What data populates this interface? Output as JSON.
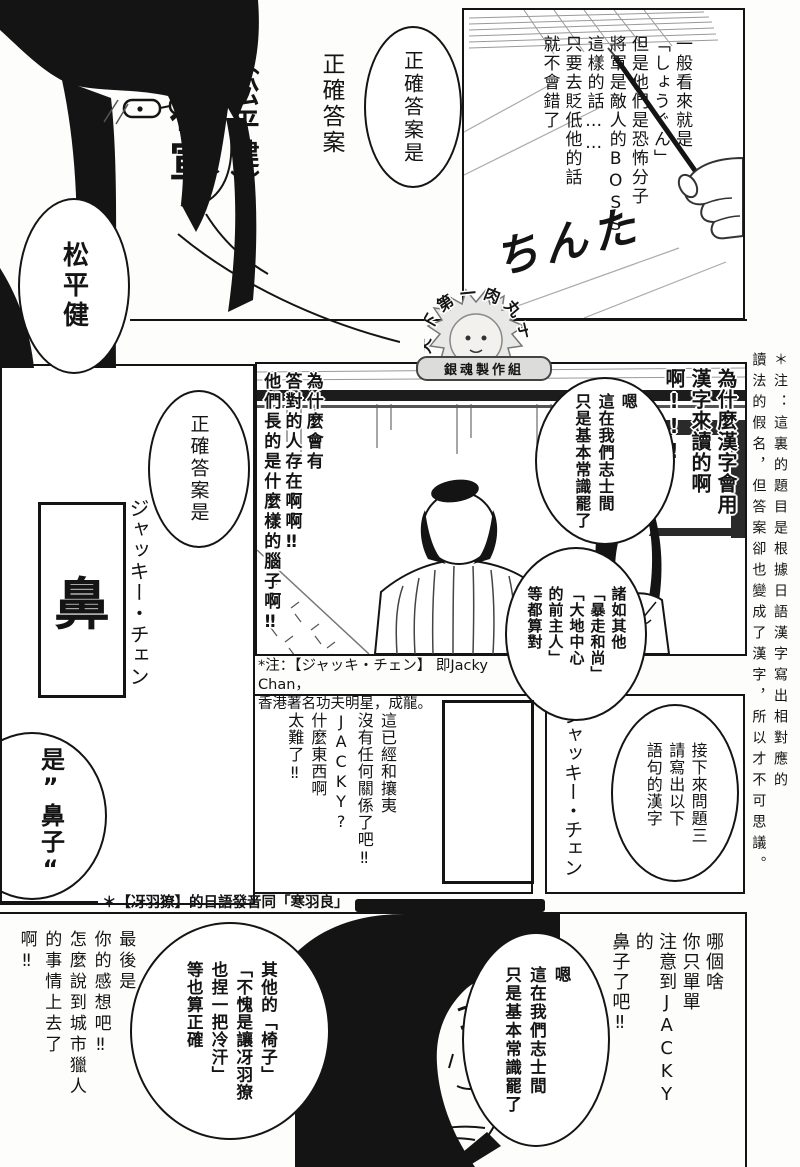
{
  "colors": {
    "ink": "#141414",
    "paper": "#ffffff"
  },
  "page": {
    "margin_note": "＊注：這裏的題目是根據日語漢字寫出相對應的\n讀法的假名，但答案卻也變成了漢字，所以才不可思議。",
    "logo": {
      "arc_text": "天下第一肉丸子",
      "badge": "銀魂製作組"
    },
    "top": {
      "narration": "一般看來就是\n「しょうぐん」\n但是他們是恐怖分子\n將軍是敵人的BOSS\n這樣的話……\n只要去貶低他的話\n就不會錯了",
      "handwriting": "ちんた",
      "bubble_correct_answer": "正確答案是",
      "answer_label": "正確答案",
      "answer_annotation": "︵松平健︶",
      "answer_main": "将軍",
      "bubble_matsudaira": "松平健"
    },
    "middle": {
      "left_panel": {
        "bubble_correct_answer": "正確答案是",
        "name_caption": "ジャッキー・チェン",
        "answer_boxed": "鼻",
        "bubble_nose": "是”鼻子“"
      },
      "scene": {
        "shout_left": "為什麼會有\n答對的人存在啊啊‼\n他們長的是什麼樣的腦子啊‼",
        "shout_right": "為什麼漢字會用\n漢字來讀的啊啊!!!",
        "bubble_common_sense": "嗯\n這在我們志士間\n只是基本常識罷了",
        "bubble_examples": "諸如其他\n「暴走和尚」\n「大地中心\n的前主人」\n等都算對"
      },
      "caption_jacky": "*注：【ジャッキ・チェン】 即Jacky Chan，\n香港著名功夫明星，成龍。"
    },
    "third": {
      "shout_rant": "這已經和攘夷\n沒有任何關係了吧‼\nJACKY?\n什麼東西啊\n太難了‼",
      "bubble_question": "接下來問題三\n請寫出以下\n語句的漢字",
      "name_caption": "ジャッキー・チェン"
    },
    "caption_ryo": "＊【冴羽獠】的日語發音同「寒羽良」",
    "bottom": {
      "retort_left": "最後是\n你的感想吧‼\n怎麼說到城市獵人\n的事情上去了啊‼",
      "bubble_others": "其他的「椅子」\n「不愧是讓冴羽獠\n也捏一把冷汗」\n等也算正確",
      "bubble_common_sense": "嗯\n這在我們志士間\n只是基本常識罷了",
      "retort_right": "哪個啥\n你只單單\n注意到JACKY的\n鼻子了吧‼"
    }
  }
}
